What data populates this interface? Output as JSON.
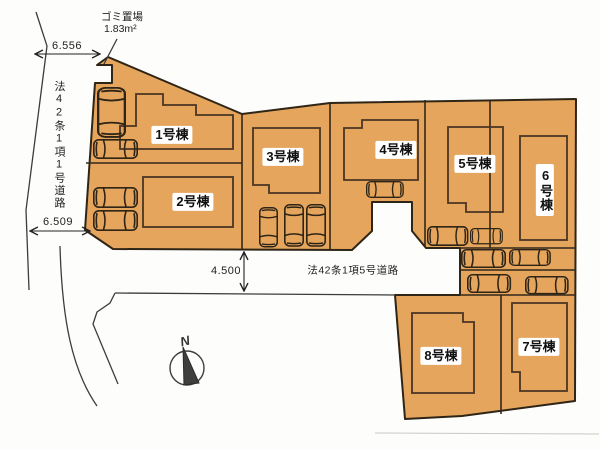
{
  "site": {
    "buildings": [
      {
        "label": "1号棟"
      },
      {
        "label": "2号棟"
      },
      {
        "label": "3号棟"
      },
      {
        "label": "4号棟"
      },
      {
        "label": "5号棟"
      },
      {
        "label": "6号棟"
      },
      {
        "label": "7号棟"
      },
      {
        "label": "8号棟"
      }
    ],
    "dimensions": {
      "west_road_upper": "6.556",
      "west_road_lower": "6.509",
      "south_road_width": "4.500"
    },
    "roads": {
      "west_road_name": "法42条1項1号道路",
      "south_road_name": "法42条1項5号道路"
    },
    "waste_station": {
      "name": "ゴミ置場",
      "area": "1.83m²"
    },
    "compass": {
      "north_label": "N"
    },
    "colors": {
      "lot_fill": "#e5a55c",
      "boundary_line": "#2f2517",
      "building_line": "#4a3523",
      "road_line": "#3c3c3c",
      "label_background": "#ffffff",
      "text": "#1d1d1d"
    }
  }
}
